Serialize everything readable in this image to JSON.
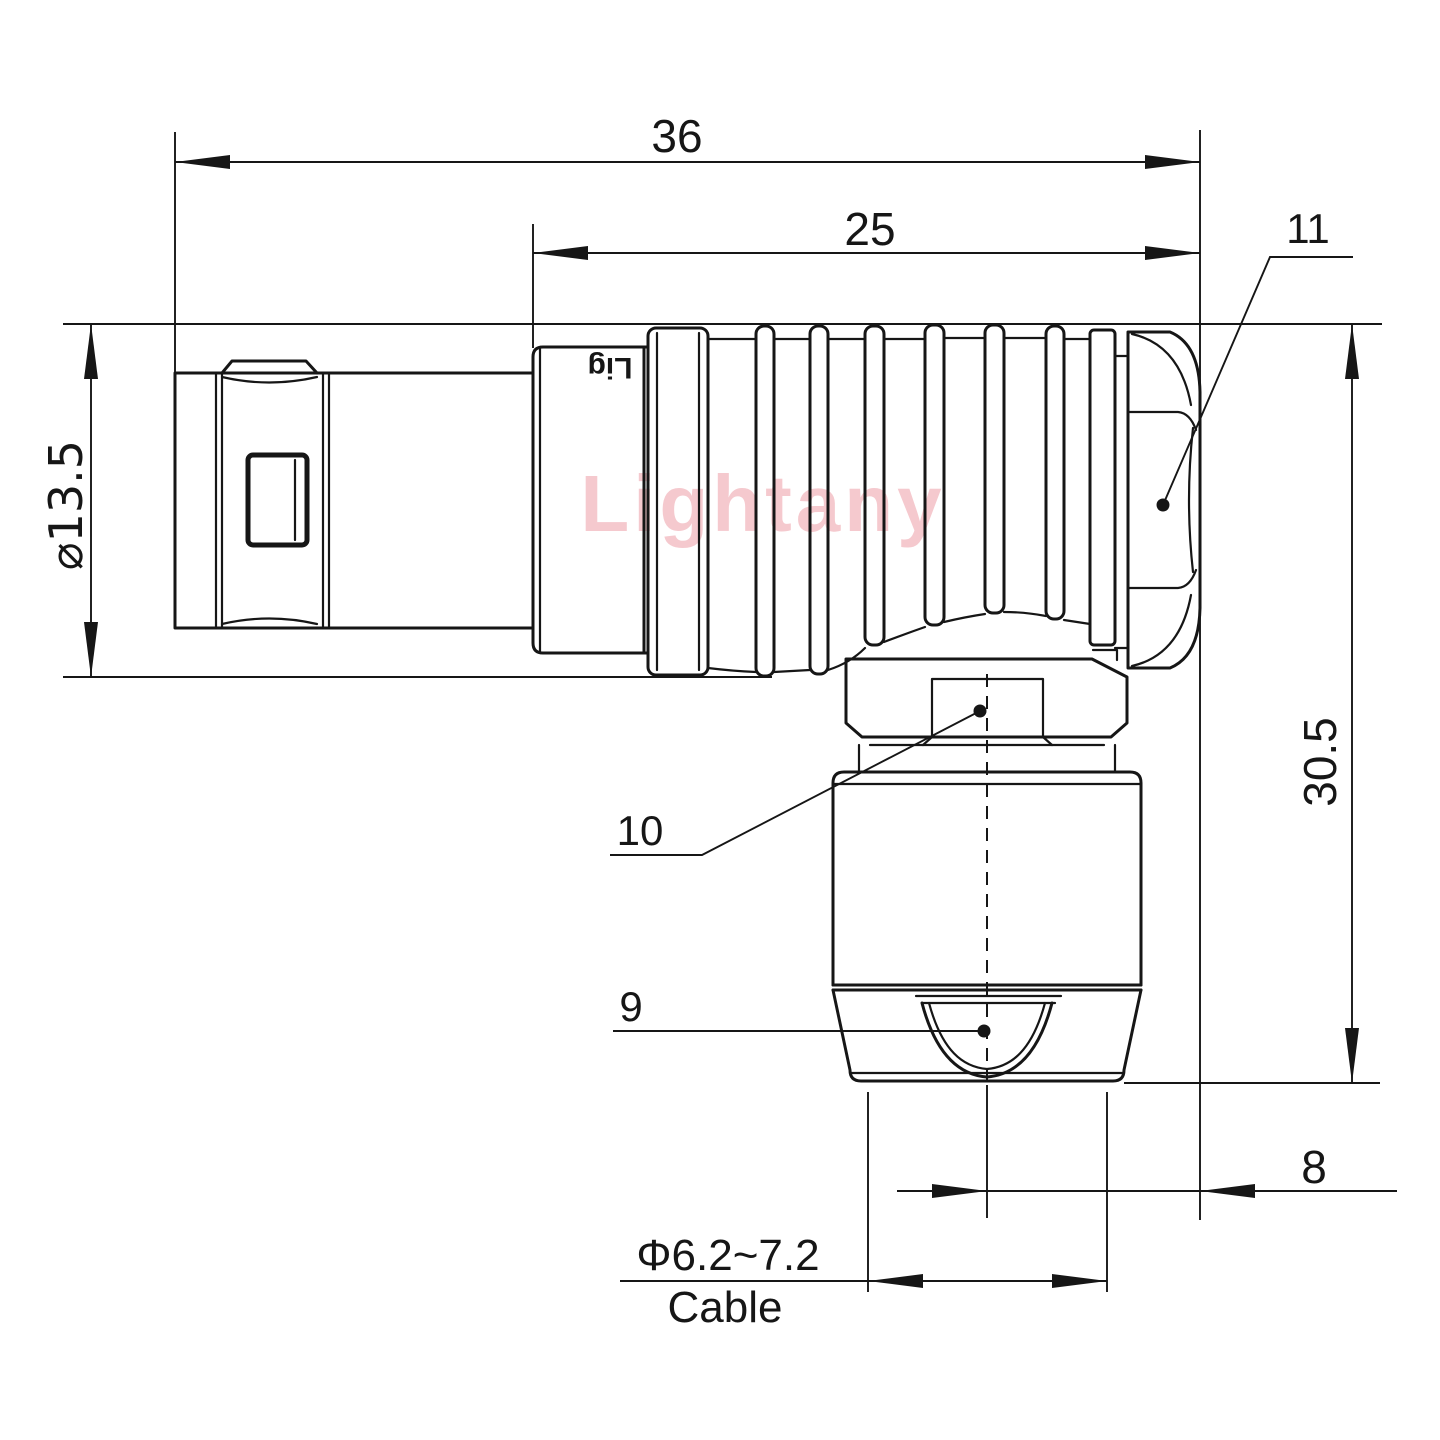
{
  "colors": {
    "ink": "#161616",
    "watermark": "#f5c9ce",
    "background": "#ffffff"
  },
  "watermark": {
    "text": "Lightany"
  },
  "connector": {
    "engraving": "Lig"
  },
  "dimensions": {
    "total_length": "36",
    "rear_length": "25",
    "front_diameter": "⌀13.5",
    "total_height": "30.5",
    "rear_offset": "8",
    "cable_diameter": "Φ6.2~7.2",
    "cable_label": "Cable"
  },
  "part_labels": {
    "back_nut": "11",
    "clamp_flange": "10",
    "cable_bushing": "9"
  }
}
